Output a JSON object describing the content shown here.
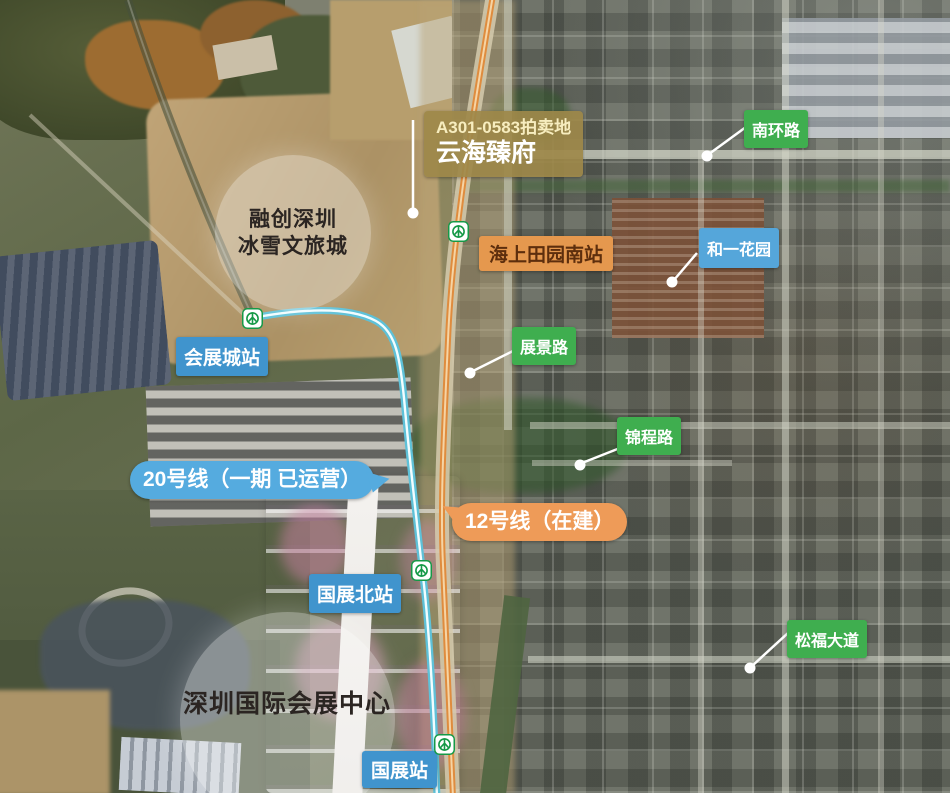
{
  "labels": {
    "auction_plot_line1": "A301-0583拍卖地",
    "auction_plot_line2": "云海臻府",
    "sunac_line1": "融创深圳",
    "sunac_line2": "冰雪文旅城",
    "haishang_tianyuan_south_station": "海上田园南站",
    "heyi_garden": "和一花园",
    "nanhuan_road": "南环路",
    "huizhancheng_station": "会展城站",
    "zhanjing_road": "展景路",
    "jincheng_road": "锦程路",
    "line20_label": "20号线（一期 已运营）",
    "line12_label": "12号线（在建）",
    "guozhan_north_station": "国展北站",
    "convention_center": "深圳国际会展中心",
    "guozhan_station": "国展站",
    "songfu_avenue": "松福大道"
  },
  "colors": {
    "badge_blue": "#4094cd",
    "badge_blue_light": "#55a6da",
    "bubble_blue": "#55abdf",
    "badge_green": "#3fae4f",
    "badge_orange": "#ee9b58",
    "badge_olive": "rgba(157,136,73,0.92)",
    "badge_tan_orange": "#e5984e",
    "line20_color": "#5ec1d8",
    "line12_color": "#df8c3e",
    "metro_green": "#159947"
  },
  "icons": {
    "metro_station": "shenzhen-metro-logo"
  }
}
